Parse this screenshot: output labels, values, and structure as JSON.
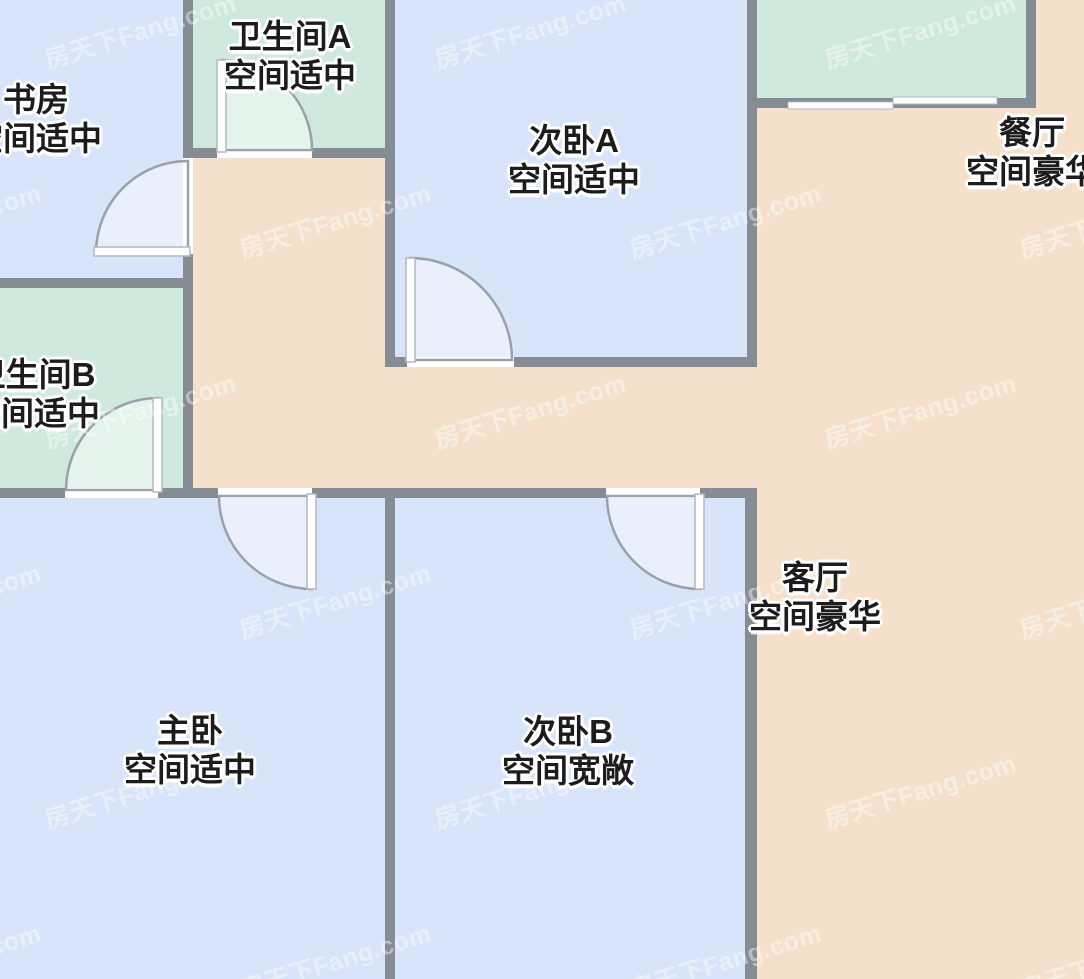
{
  "watermark": {
    "text": "房天下Fang.com"
  },
  "plan": {
    "rooms": [
      {
        "id": "study",
        "name": "书房",
        "size_label": "空间适中"
      },
      {
        "id": "bathroom-a",
        "name": "卫生间A",
        "size_label": "空间适中"
      },
      {
        "id": "bedroom-a",
        "name": "次卧A",
        "size_label": "空间适中"
      },
      {
        "id": "dining-room",
        "name": "餐厅",
        "size_label": "空间豪华"
      },
      {
        "id": "bathroom-b",
        "name": "卫生间B",
        "size_label": "空间适中"
      },
      {
        "id": "master-bedroom",
        "name": "主卧",
        "size_label": "空间适中"
      },
      {
        "id": "bedroom-b",
        "name": "次卧B",
        "size_label": "空间宽敞"
      },
      {
        "id": "living-room",
        "name": "客厅",
        "size_label": "空间豪华"
      }
    ],
    "colors": {
      "bedroom_fill": "#d8e4f9",
      "bathroom_fill": "#cfe9de",
      "public_fill": "#f5e1cb",
      "wall": "#858c94",
      "door_leaf": "#ffffff",
      "door_arc_stroke": "#9aa1a9"
    }
  }
}
